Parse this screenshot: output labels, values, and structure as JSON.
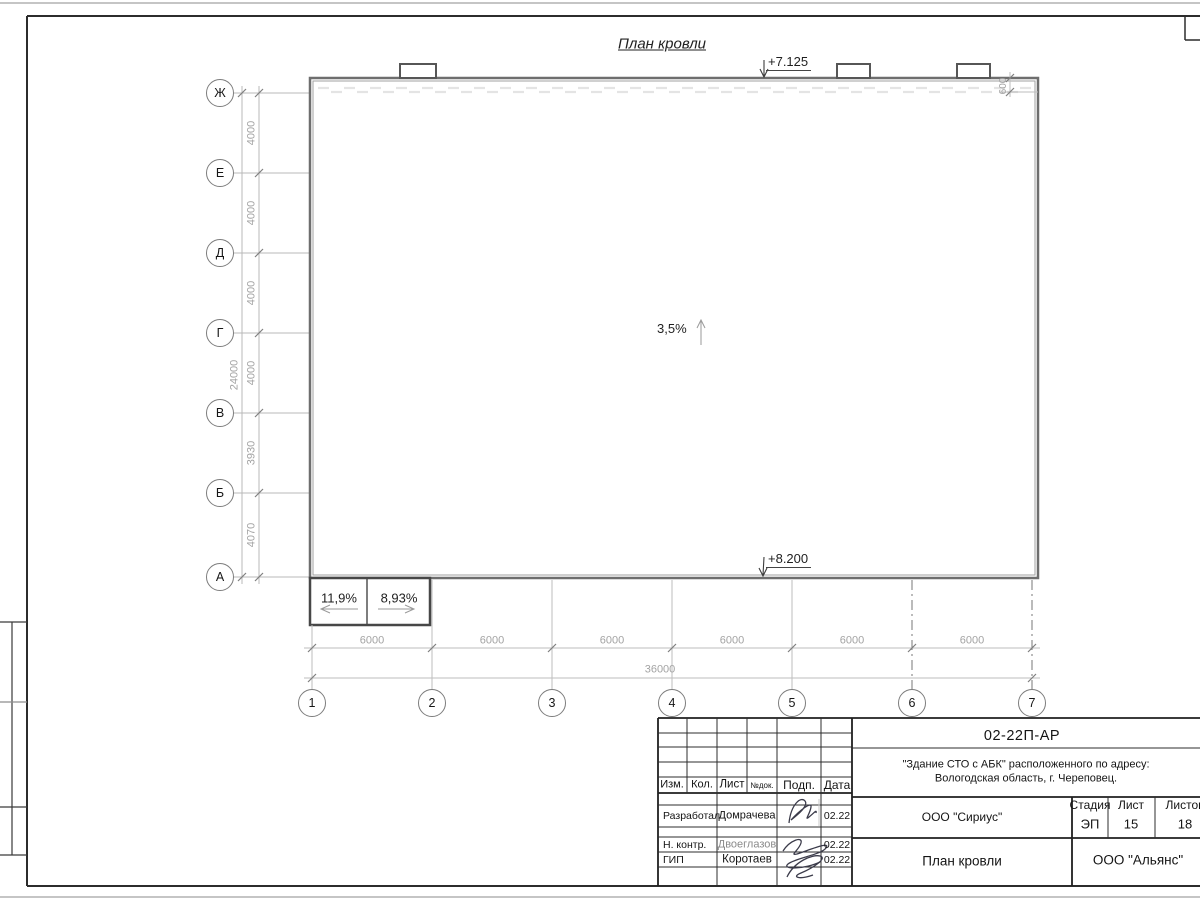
{
  "drawing": {
    "title": "План кровли",
    "elevation_top": "+7.125",
    "elevation_bottom": "+8.200",
    "slope_main": "3,5%",
    "slope_ramp_left": "11,9%",
    "slope_ramp_right": "8,93%",
    "parapet_offset": "600",
    "row_axes": [
      "Ж",
      "Е",
      "Д",
      "Г",
      "В",
      "Б",
      "А"
    ],
    "row_dims": [
      "4000",
      "4000",
      "4000",
      "4000",
      "3930",
      "4070"
    ],
    "row_total": "24000",
    "col_axes": [
      "1",
      "2",
      "3",
      "4",
      "5",
      "6",
      "7"
    ],
    "col_dims": [
      "6000",
      "6000",
      "6000",
      "6000",
      "6000",
      "6000"
    ],
    "col_total": "36000"
  },
  "title_block": {
    "doc_number": "02-22П-АР",
    "project_line1": "\"Здание СТО с АБК\" расположенного по адресу:",
    "project_line2": "Вологодская область, г. Череповец.",
    "columns": [
      "Изм.",
      "Кол.",
      "Лист",
      "№док.",
      "Подп.",
      "Дата"
    ],
    "rows": [
      {
        "role": "Разработал",
        "name": "Домрачева",
        "date": "02.22"
      },
      {
        "role": "Н. контр.",
        "name": "Двоеглазов",
        "date": "02.22"
      },
      {
        "role": "ГИП",
        "name": "Коротаев",
        "date": "02.22"
      }
    ],
    "org_middle": "ООО \"Сириус\"",
    "sheet_title": "План кровли",
    "org_bottom": "ООО \"Альянс\"",
    "stage_label": "Стадия",
    "sheet_label": "Лист",
    "sheets_label": "Листов",
    "stage_value": "ЭП",
    "sheet_value": "15",
    "sheets_value": "18"
  }
}
